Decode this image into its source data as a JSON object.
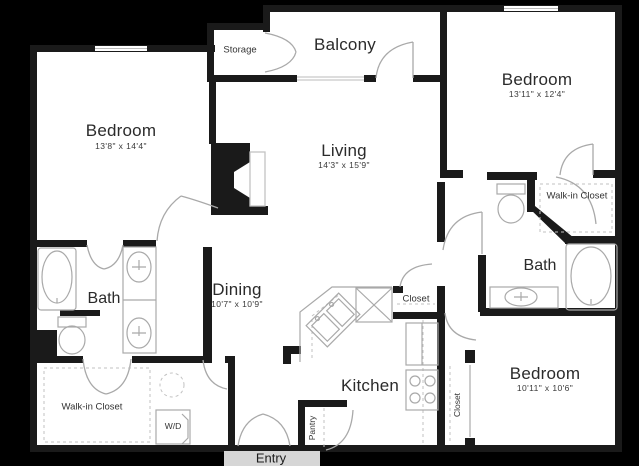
{
  "title": "Apartment floor plan",
  "colors": {
    "background": "#000000",
    "floor": "#ffffff",
    "wall": "#1a1a1a",
    "fixture_outline": "#a9a9a9",
    "dashed_line": "#c2c2c2",
    "label_text": "#2b2b2b"
  },
  "rooms": {
    "bedroom_left": {
      "label": "Bedroom",
      "dims": "13'8\" x 14'4\""
    },
    "storage": {
      "label": "Storage"
    },
    "balcony": {
      "label": "Balcony"
    },
    "bedroom_top_right": {
      "label": "Bedroom",
      "dims": "13'11\" x 12'4\""
    },
    "living": {
      "label": "Living",
      "dims": "14'3\" x 15'9\""
    },
    "walkin_right": {
      "label": "Walk-in Closet"
    },
    "bath_right": {
      "label": "Bath"
    },
    "bedroom_bottom_right": {
      "label": "Bedroom",
      "dims": "10'11\" x 10'6\""
    },
    "closet_bedroom": {
      "label": "Closet"
    },
    "dining": {
      "label": "Dining",
      "dims": "10'7\" x 10'9\""
    },
    "bath_left": {
      "label": "Bath"
    },
    "kitchen": {
      "label": "Kitchen"
    },
    "closet_hall": {
      "label": "Closet"
    },
    "walkin_left": {
      "label": "Walk-in Closet"
    },
    "laundry": {
      "label": "W/D"
    },
    "pantry": {
      "label": "Pantry"
    },
    "entry": {
      "label": "Entry"
    }
  }
}
